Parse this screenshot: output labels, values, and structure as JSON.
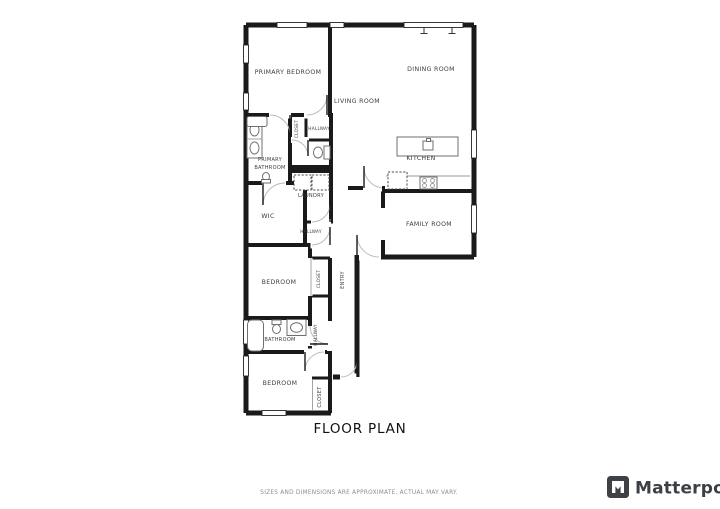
{
  "page": {
    "background_color": "#ffffff"
  },
  "floor_plan": {
    "title": "FLOOR PLAN",
    "wall_color": "#1a1a1a",
    "door_arc_color": "#bcbcbc",
    "fixture_color": "#6f6f6f",
    "label_color": "#3c3c3c",
    "rooms": [
      {
        "label": "PRIMARY BEDROOM"
      },
      {
        "label": "DINING ROOM"
      },
      {
        "label": "LIVING ROOM"
      },
      {
        "label": "HALLWAY"
      },
      {
        "label": "CLOSET"
      },
      {
        "label": "PRIMARY BATHROOM",
        "line1": "PRIMARY",
        "line2": "BATHROOM"
      },
      {
        "label": "KITCHEN"
      },
      {
        "label": "LAUNDRY"
      },
      {
        "label": "WIC"
      },
      {
        "label": "HALLWAY"
      },
      {
        "label": "FAMILY ROOM"
      },
      {
        "label": "ENTRY"
      },
      {
        "label": "BEDROOM"
      },
      {
        "label": "CLOSET"
      },
      {
        "label": "BATHROOM"
      },
      {
        "label": "HALLWAY"
      },
      {
        "label": "BEDROOM"
      },
      {
        "label": "CLOSET"
      }
    ]
  },
  "footer": {
    "disclaimer": "SIZES AND DIMENSIONS ARE APPROXIMATE, ACTUAL MAY VARY.",
    "disclaimer_color": "#8e8e8e",
    "brand_name": "Matterport",
    "brand_color": "#3d4145",
    "brand_logo_icon": "matterport-logo-icon"
  }
}
